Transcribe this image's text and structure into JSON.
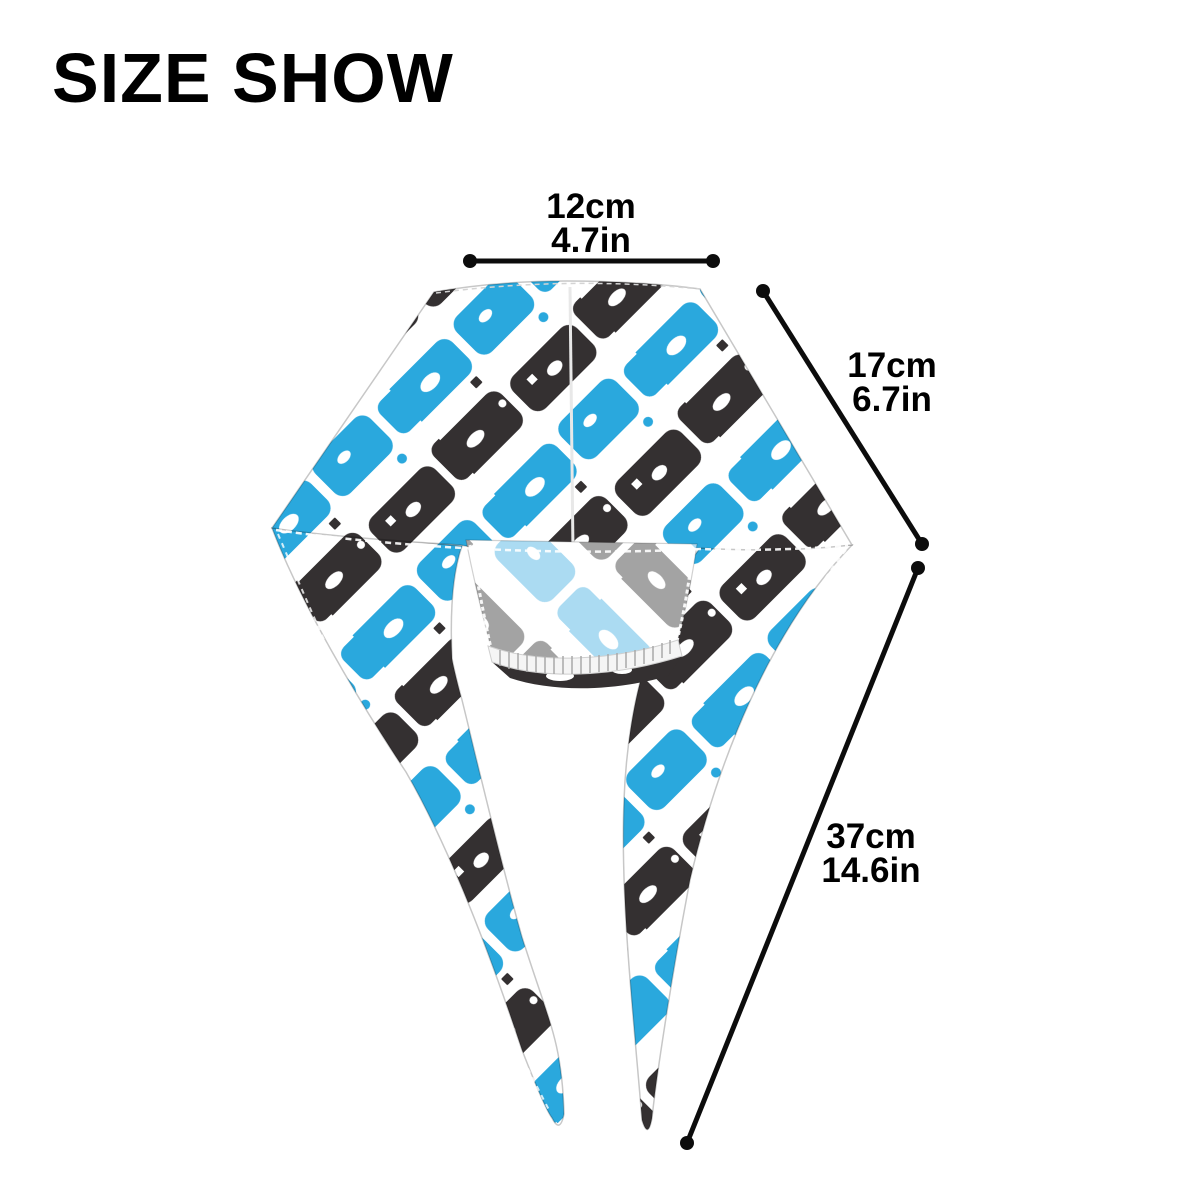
{
  "title": "SIZE SHOW",
  "product": {
    "item": "head-wrap-du-rag",
    "pattern": "blue-black-white-abstract-camo"
  },
  "measurements": {
    "top_width": {
      "cm": "12cm",
      "in": "4.7in"
    },
    "side_depth": {
      "cm": "17cm",
      "in": "6.7in"
    },
    "tail_length": {
      "cm": "37cm",
      "in": "14.6in"
    }
  },
  "colors": {
    "blue": "#2AA8DD",
    "dark": "#343031",
    "inner_blue": "#ABDBF2",
    "inner_gray": "#A3A3A3",
    "white": "#FFFFFF",
    "dimension_line": "#0C0C0C",
    "text": "#000000",
    "background": "#FFFFFF"
  }
}
